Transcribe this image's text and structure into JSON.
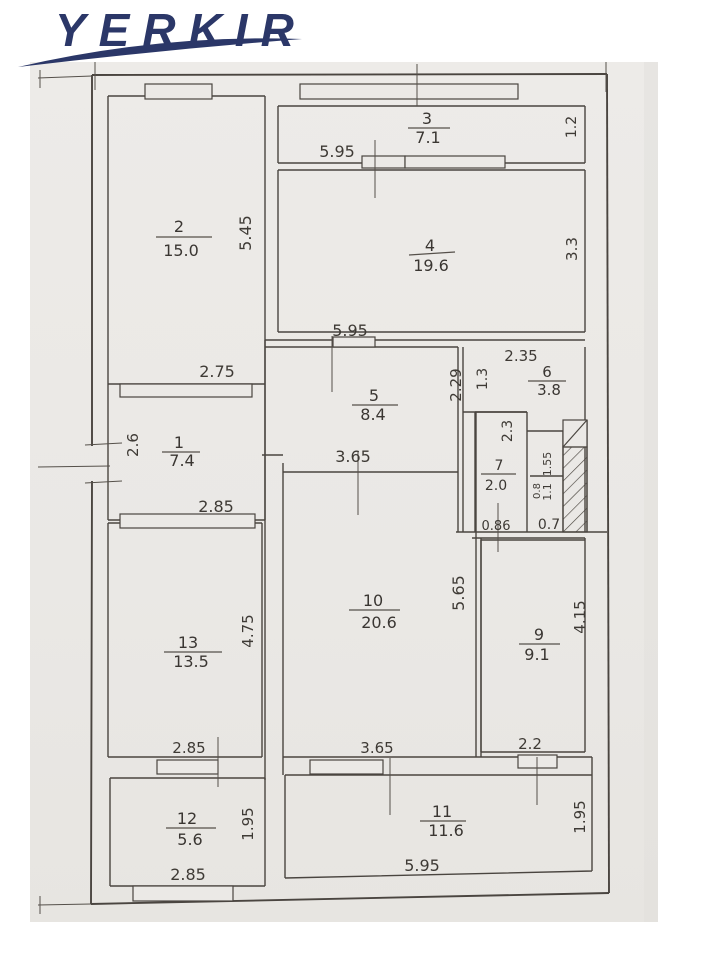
{
  "logo": {
    "text": "YERKIR"
  },
  "colors": {
    "logo_navy": "#2b3768",
    "paper": "#ebe9e6",
    "ink": "#4a4540"
  },
  "rooms": [
    {
      "number": "1",
      "area": "7.4"
    },
    {
      "number": "2",
      "area": "15.0"
    },
    {
      "number": "3",
      "area": "7.1"
    },
    {
      "number": "4",
      "area": "19.6"
    },
    {
      "number": "5",
      "area": "8.4"
    },
    {
      "number": "6",
      "area": "3.8"
    },
    {
      "number": "7",
      "area": "2.0"
    },
    {
      "number": "9",
      "area": "9.1"
    },
    {
      "number": "10",
      "area": "20.6"
    },
    {
      "number": "11",
      "area": "11.6"
    },
    {
      "number": "12",
      "area": "5.6"
    },
    {
      "number": "13",
      "area": "13.5"
    }
  ],
  "dims": {
    "top_595": "5.95",
    "r3_12": "1.2",
    "r2_545": "5.45",
    "r4_33": "3.3",
    "mid_595": "5.95",
    "r6_235": "2.35",
    "r1_275": "2.75",
    "hall_229": "2.29",
    "r6_13": "1.3",
    "r1_26": "2.6",
    "r7_23": "2.3",
    "hall_365": "3.65",
    "shaft_155": "1.55",
    "shaft_08": "0.8",
    "shaft_11": "1.1",
    "r7_086": "0.86",
    "vest_07": "0.7",
    "r1_285": "2.85",
    "r13_475": "4.75",
    "r10_565": "5.65",
    "r9_415": "4.15",
    "r13_285": "2.85",
    "r11_365": "3.65",
    "r9_22": "2.2",
    "r12_195": "1.95",
    "r11_195": "1.95",
    "r12_285": "2.85",
    "r11_595": "5.95"
  }
}
